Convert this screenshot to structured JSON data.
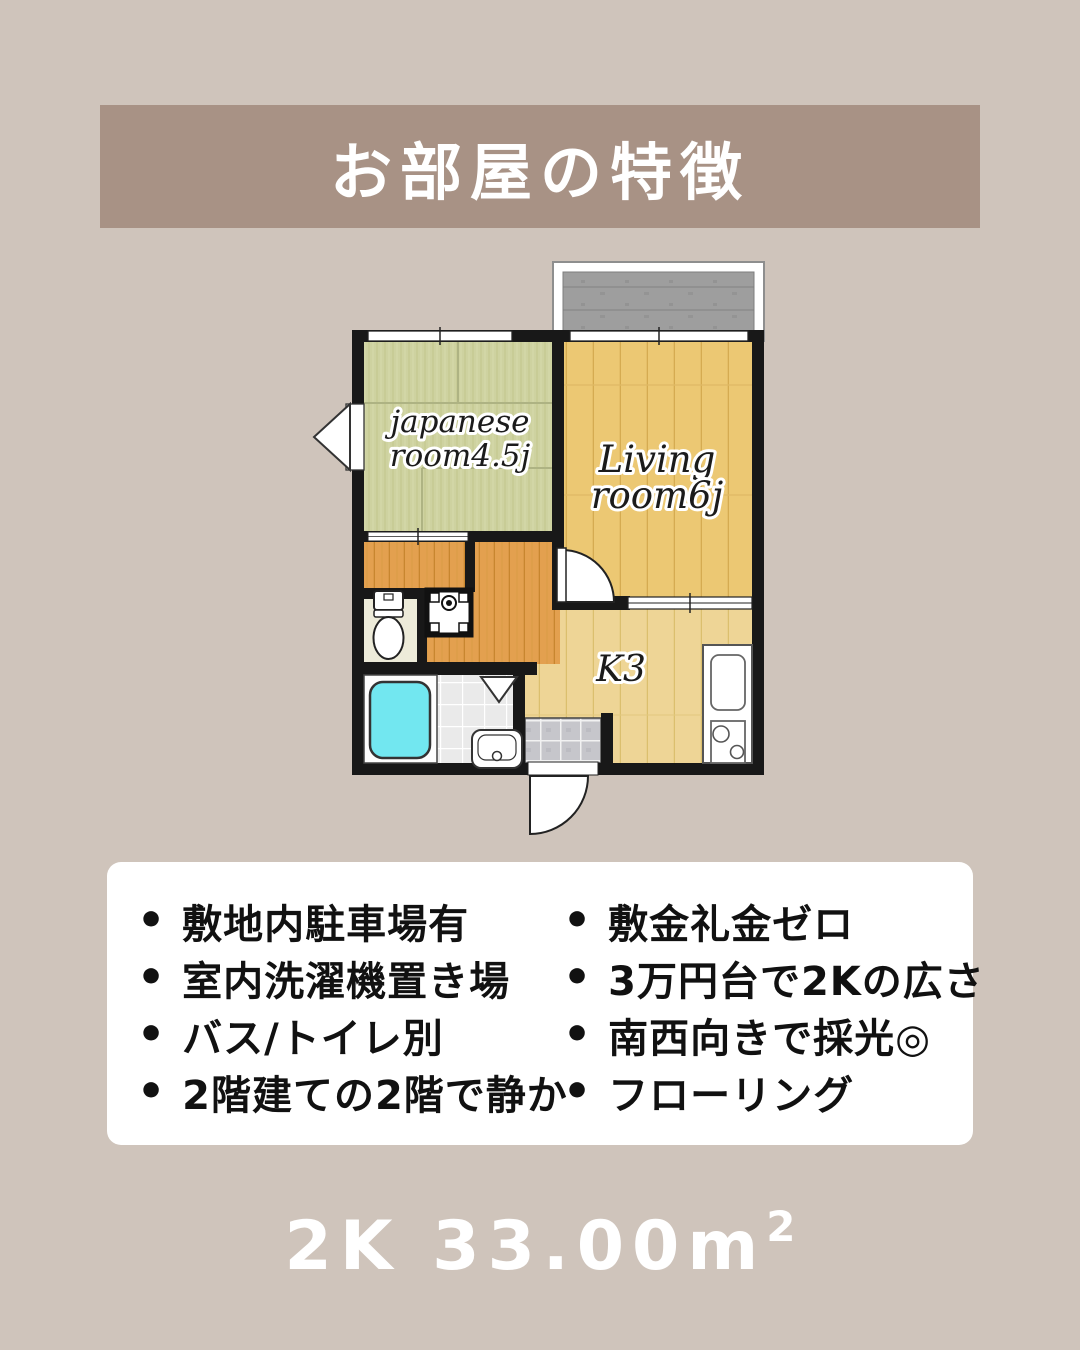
{
  "header": {
    "title": "お部屋の特徴"
  },
  "floor_plan": {
    "labels": {
      "japanese_line1": "japanese",
      "japanese_line2": "room4.5j",
      "living_line1": "Living",
      "living_line2": "room6j",
      "kitchen": "K3"
    },
    "rooms": [
      {
        "name": "japanese-room",
        "label": "japanese room4.5j"
      },
      {
        "name": "living-room",
        "label": "Living room6j"
      },
      {
        "name": "kitchen",
        "label": "K3"
      },
      {
        "name": "balcony"
      },
      {
        "name": "bathroom"
      },
      {
        "name": "toilet"
      },
      {
        "name": "entrance"
      }
    ]
  },
  "features": {
    "bullet": "•",
    "left": [
      "敷地内駐車場有",
      "室内洗濯機置き場",
      "バス/トイレ別",
      "2階建ての2階で静か"
    ],
    "right": [
      "敷金礼金ゼロ",
      "3万円台で2Kの広さ",
      "南西向きで採光◎",
      "フローリング"
    ]
  },
  "footer": {
    "floor_type": "2K",
    "area": "33.00",
    "unit": "m",
    "unit_sup": "2"
  },
  "colors": {
    "page_background": "#cfc4bb",
    "header_band": "#a89285",
    "header_text": "#ffffff",
    "card_background": "#ffffff",
    "body_text": "#111111",
    "footer_text": "#ffffff",
    "tatami": "#ced2a0",
    "living_wood": "#ecc873",
    "kitchen_wood": "#eed596",
    "closet_wood": "#e3a04f",
    "balcony_gray": "#9e9e9e",
    "bathtub_cyan": "#72e7f0",
    "walls": "#181818"
  }
}
